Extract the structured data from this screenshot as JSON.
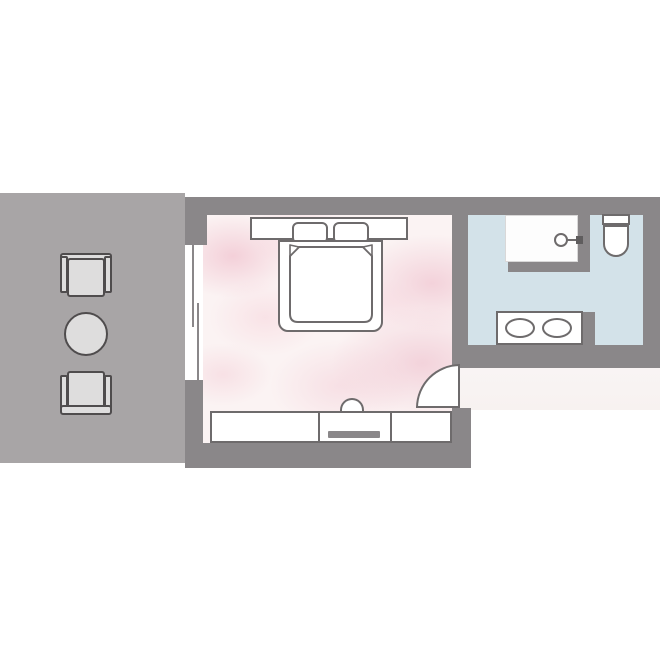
{
  "palette": {
    "background": "#ffffff",
    "wall": "#8a8789",
    "balcony-floor": "#a8a5a6",
    "balcony-furniture-fill": "#dedddd",
    "balcony-furniture-outline": "#4f4c4d",
    "bedroom-floor-base": "#fbf3f3",
    "bedroom-floor-accent": "#f1c4d0",
    "bathroom-floor": "#d3e2e9",
    "corridor-floor": "#f8f4f3",
    "fixture-fill": "#ffffff",
    "fixture-outline": "#6e6b6c"
  },
  "floorplan": {
    "type": "hotel-room-floor-plan",
    "rooms": [
      {
        "id": "balcony",
        "floor_color": "#a8a5a6",
        "furniture": [
          "armchair-top",
          "round-table",
          "armchair-bottom"
        ]
      },
      {
        "id": "bedroom",
        "floor_color": "#fbf3f3",
        "furniture": [
          "headboard-with-side-tables",
          "pillow-left",
          "pillow-right",
          "double-bed",
          "duvet-with-folded-corners",
          "sliding-glass-door",
          "entry-door-swing",
          "sideboard-left",
          "tv-console",
          "sideboard-right",
          "stool"
        ]
      },
      {
        "id": "bathroom",
        "floor_color": "#d3e2e9",
        "furniture": [
          "walk-in-shower",
          "shower-head",
          "toilet",
          "double-sink-vanity"
        ]
      },
      {
        "id": "entry-corridor",
        "floor_color": "#f8f4f3",
        "furniture": []
      }
    ]
  }
}
